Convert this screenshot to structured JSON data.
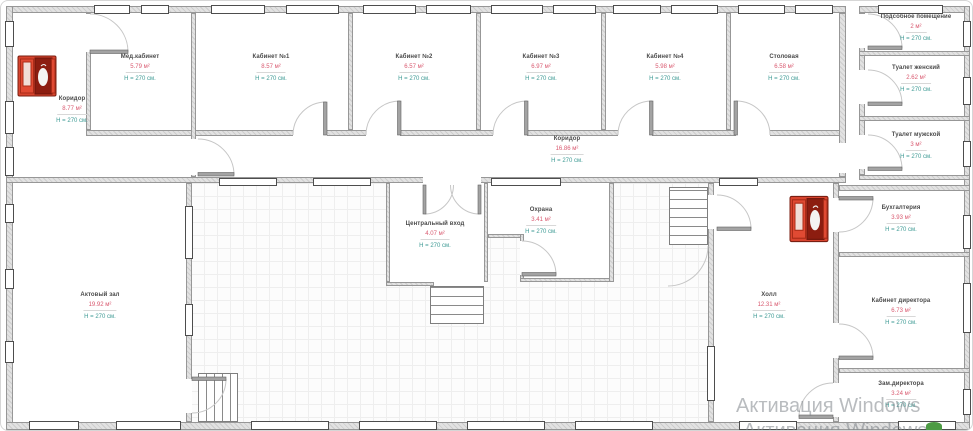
{
  "rooms": [
    {
      "name": "Коридор",
      "area": "8.77 м²",
      "height": "H = 270 см."
    },
    {
      "name": "Мед.кабинет",
      "area": "5.79 м²",
      "height": "H = 270 см."
    },
    {
      "name": "Кабинет №1",
      "area": "8.57 м²",
      "height": "H = 270 см."
    },
    {
      "name": "Кабинет №2",
      "area": "6.57 м²",
      "height": "H = 270 см."
    },
    {
      "name": "Кабинет №3",
      "area": "6.97 м²",
      "height": "H = 270 см."
    },
    {
      "name": "Кабинет №4",
      "area": "5.98 м²",
      "height": "H = 270 см."
    },
    {
      "name": "Столовая",
      "area": "6.58 м²",
      "height": "H = 270 см."
    },
    {
      "name": "Коридор",
      "area": "16.86 м²",
      "height": "H = 270 см."
    },
    {
      "name": "Подсобное помещение",
      "area": "2 м²",
      "height": "H = 270 см."
    },
    {
      "name": "Туалет женский",
      "area": "2.62 м²",
      "height": "H = 270 см."
    },
    {
      "name": "Туалет мужской",
      "area": "3 м²",
      "height": "H = 270 см."
    },
    {
      "name": "Актовый зал",
      "area": "19.92 м²",
      "height": "H = 270 см."
    },
    {
      "name": "Центральный вход",
      "area": "4.07 м²",
      "height": "H = 270 см."
    },
    {
      "name": "Охрана",
      "area": "3.41 м²",
      "height": "H = 270 см."
    },
    {
      "name": "Холл",
      "area": "12.31 м²",
      "height": "H = 270 см."
    },
    {
      "name": "Бухгалтерия",
      "area": "3.93 м²",
      "height": "H = 270 см."
    },
    {
      "name": "Кабинет директора",
      "area": "6.73 м²",
      "height": "H = 270 см."
    },
    {
      "name": "Зам.директора",
      "area": "3.24 м²",
      "height": "H = 270 см."
    }
  ],
  "watermark": {
    "line1": "Активация Windows",
    "line2": "Активация Windows"
  },
  "icons": {
    "fire_cabinet": "fire-extinguisher-cabinet",
    "plant": "plant"
  },
  "colors": {
    "room_name": "#4a4a4a",
    "area_text": "#d9596f",
    "height_text": "#3d9a94",
    "wall_fill": "#e2e2e2",
    "fire_cabinet_red": "#d8442e",
    "watermark": "#80858a"
  }
}
